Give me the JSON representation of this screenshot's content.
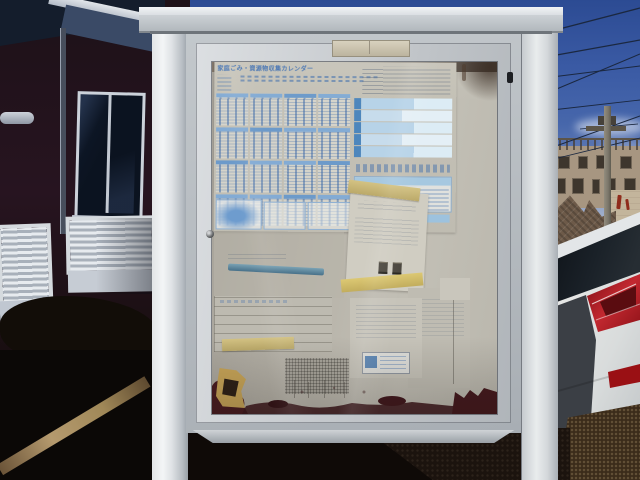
{
  "scene": {
    "type": "outdoor photograph",
    "subject": "aluminum community notice board with glass door, papers posted inside",
    "lighting": "low sun, long shadows, deep blue sky"
  },
  "notice_board": {
    "frame": "silver aluminum",
    "posts": "two white square posts",
    "latch_tab": "beige latch plate top-center",
    "lock": "small round lock on left frame",
    "stains": "dark rust-brown staining along bottom inside edge"
  },
  "calendar": {
    "title": "家庭ごみ・資源物収集カレンダー",
    "title_style": "blue heading, blurred/faded print",
    "months": {
      "columns": 4,
      "rows": 4,
      "count": 16
    },
    "info_rows": 5,
    "accent_color": "#4d86bc",
    "paper_color": "#c3c0b5"
  },
  "papers": {
    "middle_notice": {
      "color": "white",
      "tapes": [
        "top",
        "bottom"
      ],
      "stamps": 2
    },
    "left_faded_sheet": {
      "feature": "teal horizontal bar"
    },
    "left_table_sheet": {
      "feature": "faint ruled grid"
    },
    "bottom_right_forms": {
      "count": 2,
      "feature": "bordered box with blue block"
    },
    "torn_sticker": {
      "position": "bottom-left",
      "colors": [
        "#c8a558",
        "#2d2117"
      ]
    }
  },
  "background": {
    "left_building": {
      "wall": "dark reddish shadowed siding",
      "big_window": "dark glass, white frame",
      "louver_windows": 2,
      "downpipe": true,
      "eave": "white fascia with blue-gray soffit"
    },
    "right": {
      "sky_color": "#3a5aa4",
      "power_lines": 7,
      "utility_pole": 1,
      "apartment_building": "tan with rooftop railing and dark windows",
      "stone_wall": "brown textured gabled wall",
      "graffiti_marks": "red strokes on light wall"
    },
    "car": {
      "color": "white",
      "view": "rear quarter",
      "taillight_color": "#a81620",
      "reflector_color": "#9a1014"
    },
    "ground": {
      "asphalt": "dark with long shadow",
      "curb": "sunlit tan curb line lower-left"
    }
  },
  "palette": {
    "post_white": "#eef0f2",
    "frame_gray": "#b7bcc1",
    "board_interior": "#b5b1a7",
    "calendar_blue": "#4d86bc",
    "rust": "#441a1f",
    "sky_top": "#2c4b93"
  }
}
